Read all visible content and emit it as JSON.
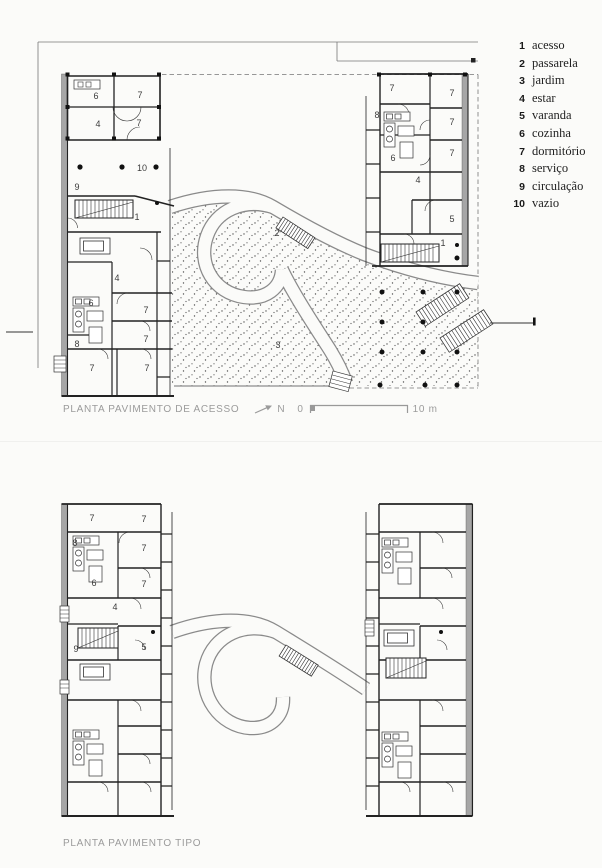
{
  "legend": {
    "items": [
      {
        "n": "1",
        "label": "acesso"
      },
      {
        "n": "2",
        "label": "passarela"
      },
      {
        "n": "3",
        "label": "jardim"
      },
      {
        "n": "4",
        "label": "estar"
      },
      {
        "n": "5",
        "label": "varanda"
      },
      {
        "n": "6",
        "label": "cozinha"
      },
      {
        "n": "7",
        "label": "dormitório"
      },
      {
        "n": "8",
        "label": "serviço"
      },
      {
        "n": "9",
        "label": "circulação"
      },
      {
        "n": "10",
        "label": "vazio"
      }
    ]
  },
  "plan_access": {
    "title": "PLANTA PAVIMENTO DE ACESSO",
    "north_label": "N",
    "scale": {
      "zero": "0",
      "end": "10 m"
    },
    "left": [
      "6",
      "7",
      "4",
      "7",
      "9",
      "10",
      "1",
      "4",
      "6",
      "7",
      "7",
      "8",
      "7",
      "7"
    ],
    "right": [
      "7",
      "7",
      "8",
      "7",
      "6",
      "7",
      "4",
      "5",
      "1"
    ],
    "garden": [
      "2",
      "3"
    ]
  },
  "plan_typical": {
    "title": "PLANTA PAVIMENTO TIPO",
    "left": [
      "7",
      "7",
      "8",
      "7",
      "6",
      "7",
      "4",
      "9",
      "5"
    ]
  },
  "colors": {
    "ink": "#222222",
    "wall_gray": "#a6a6a6",
    "caption_gray": "#9b9b9b"
  }
}
